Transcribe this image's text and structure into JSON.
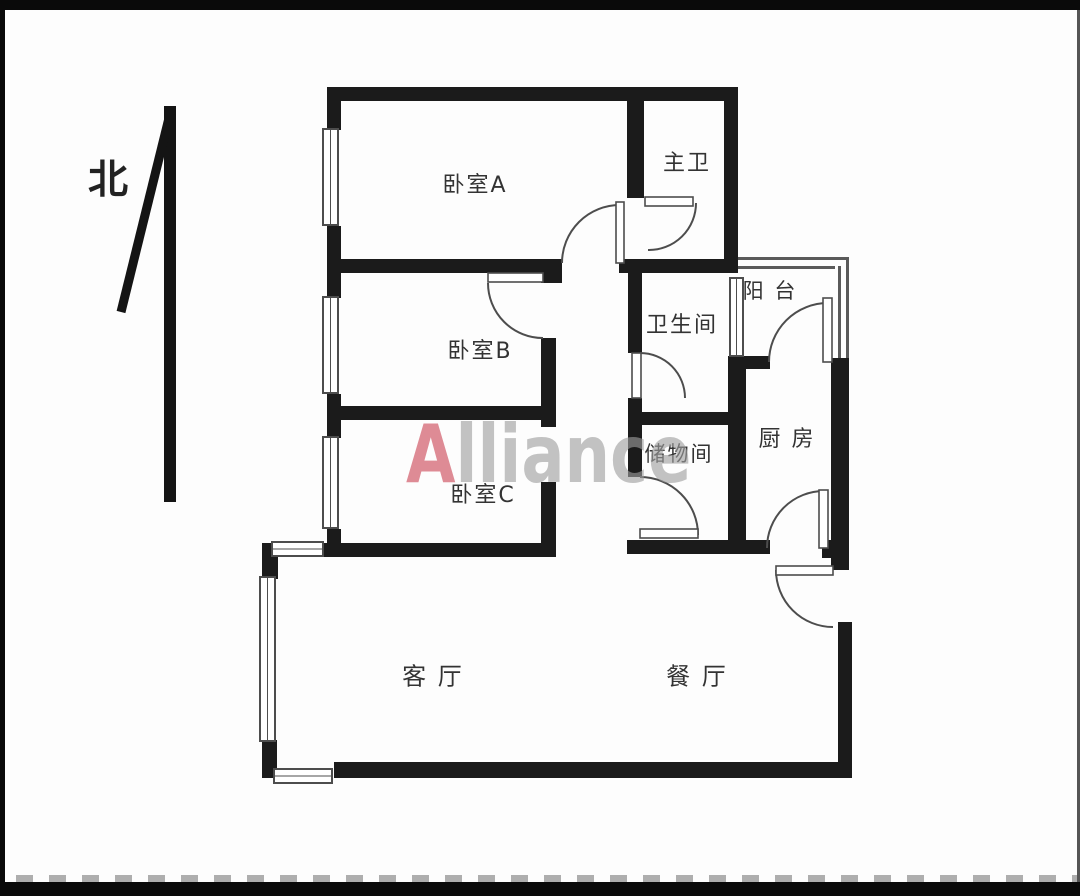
{
  "compass": {
    "label": "北"
  },
  "watermark": {
    "lead": "A",
    "rest": "lliance"
  },
  "rooms": {
    "bedroom_a": {
      "label": "卧室A"
    },
    "master_bath": {
      "label": "主卫"
    },
    "bedroom_b": {
      "label": "卧室B"
    },
    "bathroom": {
      "label": "卫生间"
    },
    "balcony": {
      "label": "阳 台"
    },
    "bedroom_c": {
      "label": "卧室C"
    },
    "storage": {
      "label": "储物间"
    },
    "kitchen": {
      "label": "厨 房"
    },
    "living": {
      "label": "客 厅"
    },
    "dining": {
      "label": "餐 厅"
    }
  },
  "colors": {
    "wall": "#1b1b1b",
    "thin_line": "#4d4d4d",
    "label_text": "#333333",
    "watermark_lead": "#d66e7a",
    "watermark_rest": "#9e9e9e",
    "frame": "#0a0a0a",
    "background": "#fdfdfd"
  }
}
